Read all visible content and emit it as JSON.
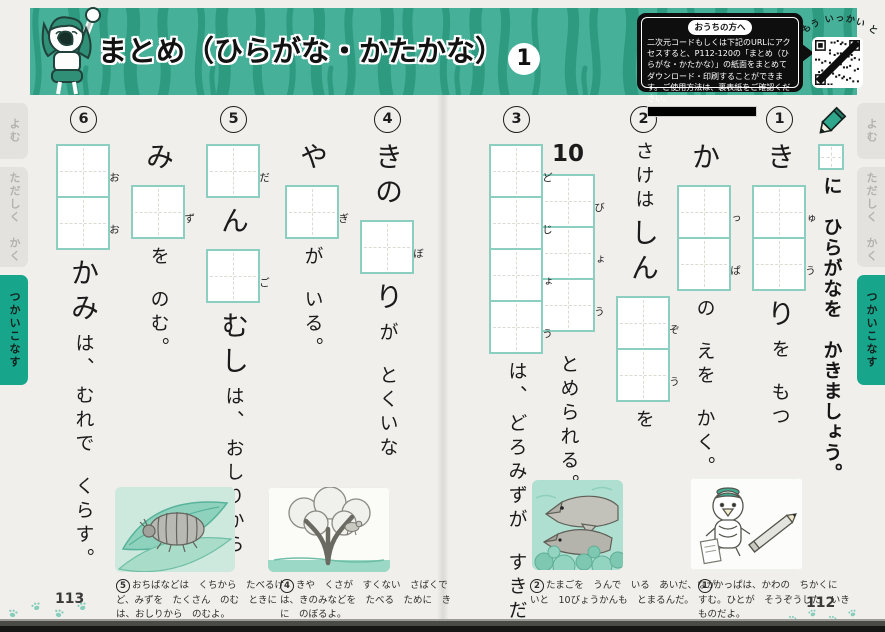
{
  "header": {
    "title": "まとめ（ひらがな・かたかな）",
    "title_number": "1",
    "parents_box": {
      "label": "おうちの方へ",
      "body": "二次元コードもしくは下記のURLにアクセスすると、P112-120の「まとめ（ひらがな・かたかな）」の紙面をまとめてダウンロード・印刷することができます。ご使用方法は、裏表紙をご確認ください。"
    },
    "qr_caption": "もう いっかい とく!"
  },
  "side_tabs": [
    {
      "label": "よむ",
      "active": false
    },
    {
      "label": "ただしく　かく",
      "active": false
    },
    {
      "label": "つかいこなす",
      "active": true
    }
  ],
  "instruction": "に　ひらがなを　かきましょう。",
  "exercises": [
    {
      "number": "1",
      "columns": [
        [
          {
            "t": "き",
            "big": true
          },
          {
            "box": "ゅ"
          },
          {
            "box": "う"
          },
          {
            "t": "り",
            "big": true
          },
          {
            "t": "を"
          },
          {
            "sp": true
          },
          {
            "t": "もつ"
          }
        ],
        [
          {
            "t": "か",
            "big": true
          },
          {
            "box": "っ"
          },
          {
            "box": "ぱ"
          },
          {
            "t": "の"
          },
          {
            "sp": true
          },
          {
            "t": "えを"
          },
          {
            "sp": true
          },
          {
            "t": "かく。"
          }
        ]
      ]
    },
    {
      "number": "2",
      "columns": [
        [
          {
            "t": "さけは"
          },
          {
            "t": "しん",
            "big": true
          },
          {
            "box": "ぞ"
          },
          {
            "box": "う"
          },
          {
            "t": "を"
          }
        ],
        [
          {
            "num": "10"
          },
          {
            "box": "び"
          },
          {
            "box": "ょ"
          },
          {
            "box": "う"
          },
          {
            "sp": true
          },
          {
            "t": "とめられる。"
          }
        ]
      ]
    },
    {
      "number": "3",
      "columns": [
        [
          {
            "box": "ど"
          },
          {
            "box": "じ"
          },
          {
            "box": "ょ"
          },
          {
            "box": "う"
          },
          {
            "t": "は、"
          },
          {
            "t": "どろみずが"
          },
          {
            "sp": true
          },
          {
            "t": "すきだ。"
          }
        ]
      ]
    },
    {
      "number": "4",
      "columns": [
        [
          {
            "t": "きの",
            "big": true
          },
          {
            "box": "ぼ"
          },
          {
            "t": "り",
            "big": true
          },
          {
            "t": "が"
          },
          {
            "sp": true
          },
          {
            "t": "とくいな"
          }
        ],
        [
          {
            "t": "や",
            "big": true
          },
          {
            "box": "ぎ"
          },
          {
            "t": "が"
          },
          {
            "sp": true
          },
          {
            "t": "いる。"
          }
        ]
      ]
    },
    {
      "number": "5",
      "columns": [
        [
          {
            "box": "だ"
          },
          {
            "t": "ん",
            "big": true
          },
          {
            "box": "ご"
          },
          {
            "t": "むし",
            "big": true
          },
          {
            "t": "は、"
          },
          {
            "t": "おしりから"
          }
        ],
        [
          {
            "t": "み",
            "big": true
          },
          {
            "box": "ず"
          },
          {
            "t": "を"
          },
          {
            "sp": true
          },
          {
            "t": "のむ。"
          }
        ]
      ]
    },
    {
      "number": "6",
      "columns": [
        [
          {
            "box": "お"
          },
          {
            "box": "お"
          },
          {
            "t": "かみ",
            "big": true
          },
          {
            "t": "は、"
          },
          {
            "t": "むれで"
          },
          {
            "sp": true
          },
          {
            "t": "くらす。"
          }
        ]
      ]
    }
  ],
  "captions": [
    {
      "number": "5",
      "text": "おちばなどは　くちから　たべるけど、みずを　たくさん　のむ　ときには、おしりから　のむよ。"
    },
    {
      "number": "4",
      "text": "きや　くさが　すくない　さばくでは、きのみなどを　たべる　ために　きに　のぼるよ。"
    },
    {
      "number": "2",
      "text": "たまごを　うんで　いる　あいだ、ながいと　10びょうかんも　とまるんだ。"
    },
    {
      "number": "1",
      "text": "かっぱは、かわの　ちかくに　すむ。ひとが　そうぞうした　いきものだよ。"
    }
  ],
  "page_numbers": {
    "left": "113",
    "right": "112"
  },
  "colors": {
    "header_teal": "#46b098",
    "stripe_teal": "#2e9a80",
    "tab_active_teal": "#17a68c",
    "box_border_teal": "#8ccfc0",
    "paper": "#f0efec"
  }
}
